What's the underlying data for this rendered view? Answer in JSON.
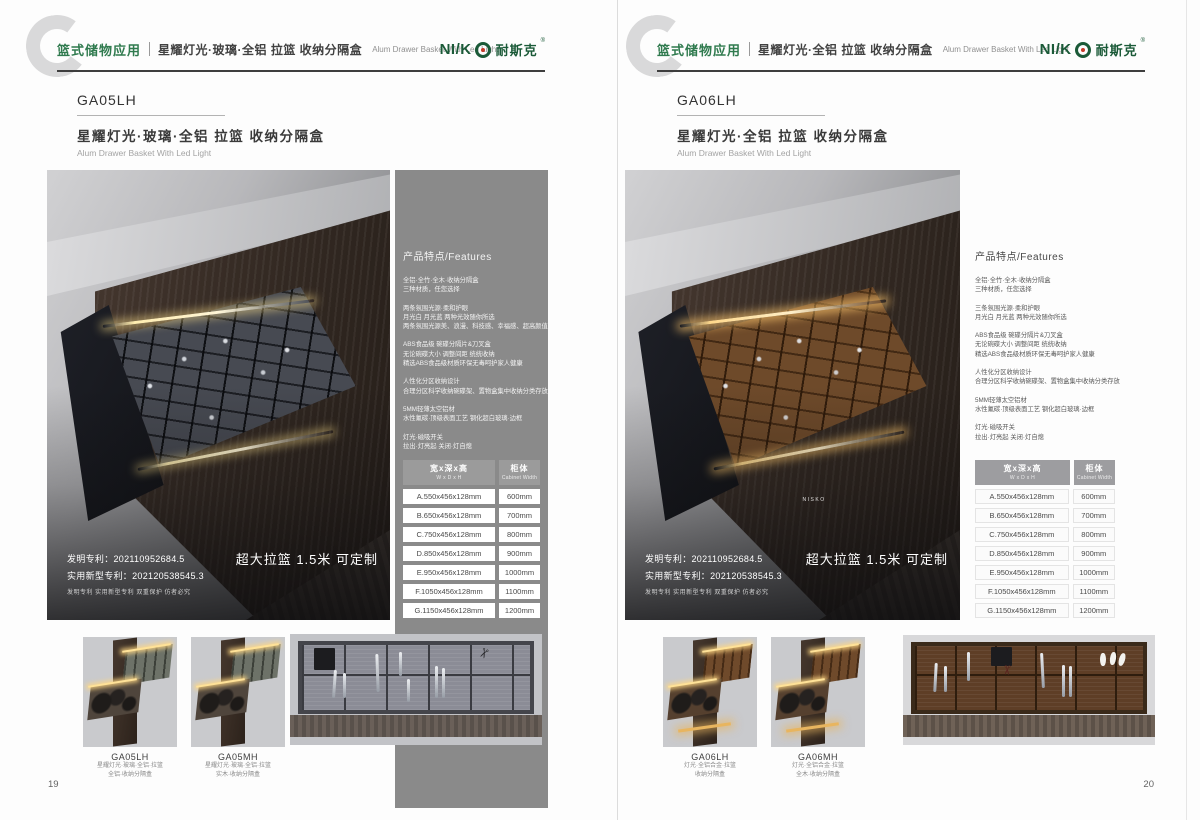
{
  "colors": {
    "accent_green": "#2f7a4e",
    "logo_green": "#1b5a38",
    "logo_dot_red": "#c63b2a",
    "panel_gray": "#8a8a8a"
  },
  "brand": {
    "logo_prefix": "NI/K",
    "logo_cn": "耐斯克",
    "logo_reg": "®",
    "photo_mark": "NISKO"
  },
  "page_left": {
    "page_no": "19",
    "header": {
      "category": "篮式储物应用",
      "title_cn": "星耀灯光·玻璃·全铝 拉篮 收纳分隔盒",
      "title_en": "Alum Drawer Basket With Led Light"
    },
    "product": {
      "code": "GA05LH",
      "title_cn": "星耀灯光·玻璃·全铝 拉篮 收纳分隔盒",
      "title_en": "Alum Drawer Basket With Led Light"
    },
    "photo": {
      "patent_line1": "发明专利：202110952684.5",
      "patent_line2": "实用新型专利：202120538545.3",
      "patent_line3": "发明专利 实用新型专利 双重保护 仿者必究",
      "banner": "超大拉篮 1.5米 可定制"
    },
    "features": {
      "heading": "产品特点/Features",
      "groups": [
        [
          "全铝·全竹·全木·收纳分隔盒",
          "三种材质，任您选择"
        ],
        [
          "两条氛围光源·柔和护眼",
          "月光白 月光蓝 两种光效随你所选",
          "两条氛围光源美、浪漫、科技感、幸福感、超高颜值"
        ],
        [
          "ABS食品级 碗碟分隔片&刀叉盒",
          "无论碗碟大小 调整间距 统统收纳",
          "精选ABS食品级材质环保无毒呵护家人健康"
        ],
        [
          "人性化分区收纳设计",
          "合理分区科学收纳碗碟架、置物盒集中收纳分类存放"
        ],
        [
          "5MM轻薄太空铝材",
          "水性氟碳·顶级表面工艺 钢化超白玻璃·边框"
        ],
        [
          "灯光·磁吸开关",
          "拉出·灯亮起 关闭·灯自熄"
        ]
      ]
    },
    "table": {
      "col1_cn": "宽x深x高",
      "col1_en": "W x D x H",
      "col2_cn": "柜体",
      "col2_en": "Cabinet Width",
      "rows": [
        [
          "A.550x456x128mm",
          "600mm"
        ],
        [
          "B.650x456x128mm",
          "700mm"
        ],
        [
          "C.750x456x128mm",
          "800mm"
        ],
        [
          "D.850x456x128mm",
          "900mm"
        ],
        [
          "E.950x456x128mm",
          "1000mm"
        ],
        [
          "F.1050x456x128mm",
          "1100mm"
        ],
        [
          "G.1150x456x128mm",
          "1200mm"
        ]
      ]
    },
    "thumbs": [
      {
        "code": "GA05LH",
        "line1": "星耀灯光·玻璃·全铝·拉篮",
        "line2": "全铝·收纳分隔盒"
      },
      {
        "code": "GA05MH",
        "line1": "星耀灯光·玻璃·全铝·拉篮",
        "line2": "实木·收纳分隔盒"
      }
    ]
  },
  "page_right": {
    "page_no": "20",
    "header": {
      "category": "篮式储物应用",
      "title_cn": "星耀灯光·全铝 拉篮 收纳分隔盒",
      "title_en": "Alum Drawer Basket With Led Light"
    },
    "product": {
      "code": "GA06LH",
      "title_cn": "星耀灯光·全铝 拉篮 收纳分隔盒",
      "title_en": "Alum Drawer Basket With Led Light"
    },
    "photo": {
      "patent_line1": "发明专利：202110952684.5",
      "patent_line2": "实用新型专利：202120538545.3",
      "patent_line3": "发明专利 实用新型专利 双重保护 仿者必究",
      "banner": "超大拉篮 1.5米 可定制"
    },
    "features": {
      "heading": "产品特点/Features",
      "groups": [
        [
          "全铝·全竹·全木·收纳分隔盒",
          "三种材质，任您选择"
        ],
        [
          "三条氛围光源·柔和护眼",
          "月光白 月光蓝 两种光效随你所选"
        ],
        [
          "ABS食品级 碗碟分隔片&刀叉盒",
          "无论碗碟大小 调整间距 统统收纳",
          "精选ABS食品级材质环保无毒呵护家人健康"
        ],
        [
          "人性化分区收纳设计",
          "合理分区科学收纳碗碟架、置物盒集中收纳分类存放"
        ],
        [
          "5MM轻薄太空铝材",
          "水性氟碳·顶级表面工艺 钢化超白玻璃·边框"
        ],
        [
          "灯光·磁吸开关",
          "拉出·灯亮起 关闭·灯自熄"
        ]
      ]
    },
    "table": {
      "col1_cn": "宽x深x高",
      "col1_en": "W x D x H",
      "col2_cn": "柜体",
      "col2_en": "Cabinet Width",
      "rows": [
        [
          "A.550x456x128mm",
          "600mm"
        ],
        [
          "B.650x456x128mm",
          "700mm"
        ],
        [
          "C.750x456x128mm",
          "800mm"
        ],
        [
          "D.850x456x128mm",
          "900mm"
        ],
        [
          "E.950x456x128mm",
          "1000mm"
        ],
        [
          "F.1050x456x128mm",
          "1100mm"
        ],
        [
          "G.1150x456x128mm",
          "1200mm"
        ]
      ]
    },
    "thumbs": [
      {
        "code": "GA06LH",
        "line1": "灯光·全铝合金·拉篮",
        "line2": "收纳分隔盒"
      },
      {
        "code": "GA06MH",
        "line1": "灯光·全铝合金·拉篮",
        "line2": "全木·收纳分隔盒"
      }
    ]
  }
}
